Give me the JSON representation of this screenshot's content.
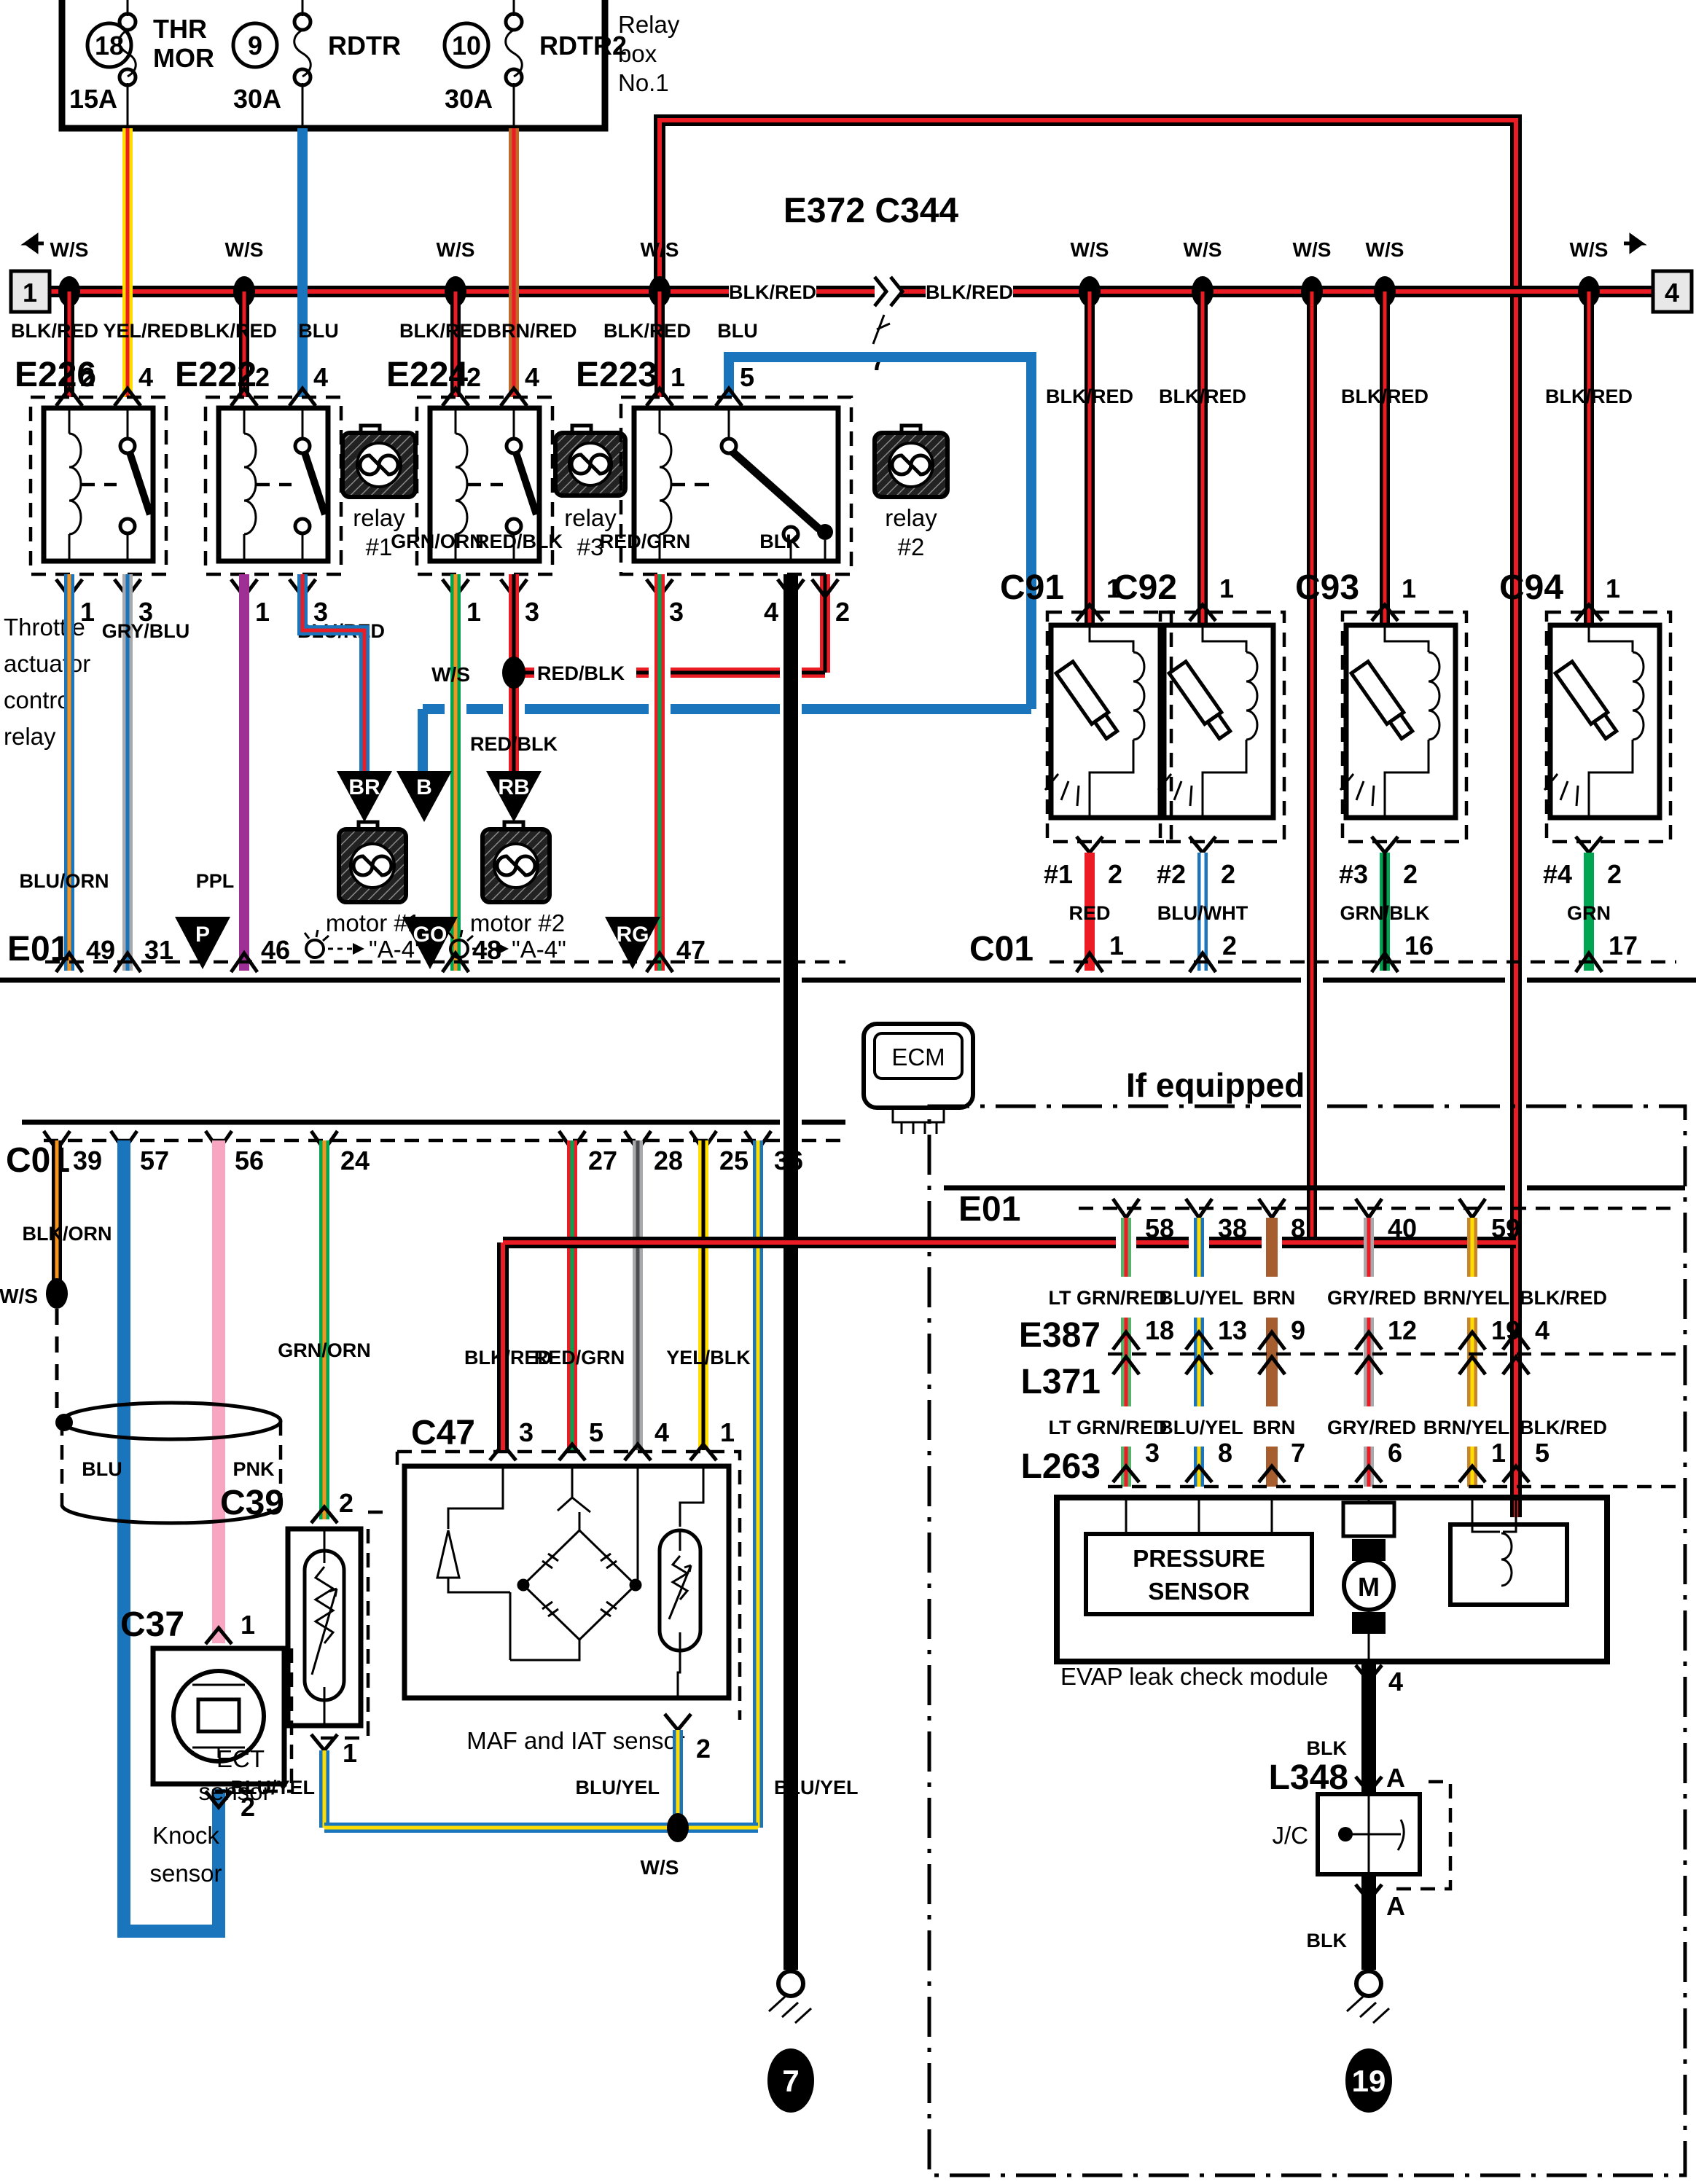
{
  "diagram": {
    "relay_box": {
      "title1": "Relay",
      "title2": "box",
      "title3": "No.1",
      "fuse1": {
        "num": "18",
        "amp": "15A",
        "name1": "THR",
        "name2": "MOR"
      },
      "fuse2": {
        "num": "9",
        "amp": "30A",
        "name": "RDTR"
      },
      "fuse3": {
        "num": "10",
        "amp": "30A",
        "name": "RDTR2"
      }
    },
    "terminal_left": "1",
    "terminal_right": "4",
    "ws": "W/S",
    "inline": {
      "id": "E372 C344",
      "pin": "7"
    },
    "wire": {
      "blkred": "BLK/RED",
      "yelred": "YEL/RED",
      "blu": "BLU",
      "brnred": "BRN/RED",
      "bluorn": "BLU/ORN",
      "gryblu": "GRY/BLU",
      "ppl": "PPL",
      "blured": "BLU/RED",
      "grnorn": "GRN/ORN",
      "redblk": "RED/BLK",
      "redgrn": "RED/GRN",
      "blk": "BLK",
      "red": "RED",
      "bluwht": "BLU/WHT",
      "grnblk": "GRN/BLK",
      "grn": "GRN",
      "blkorn": "BLK/ORN",
      "pnk": "PNK",
      "bluyel": "BLU/YEL",
      "ltgrnred": "LT GRN/RED",
      "brn": "BRN",
      "gryred": "GRY/RED",
      "brnyel": "BRN/YEL",
      "yelblk": "YEL/BLK"
    },
    "relays": {
      "e226": "E226",
      "e222": "E222",
      "e224": "E224",
      "e223": "E223",
      "throttle1": "Throttle",
      "throttle2": "actuator",
      "throttle3": "control",
      "throttle4": "relay",
      "fan_a": "relay",
      "fan1b": "#1",
      "fan3b": "#3",
      "fan2b": "#2"
    },
    "tri": {
      "br": "BR",
      "b": "B",
      "rb": "RB",
      "p": "P",
      "go": "GO",
      "rg": "RG"
    },
    "motor1": "motor #1",
    "motor2": "motor #2",
    "a4": "\"A-4\"",
    "e01": "E01",
    "c01": "C01",
    "inj": {
      "c91": "C91",
      "c92": "C92",
      "c93": "C93",
      "c94": "C94",
      "n1": "#1",
      "n2": "#2",
      "n3": "#3",
      "n4": "#4"
    },
    "ecm": "ECM",
    "sensors": {
      "c39": "C39",
      "c47": "C47",
      "c37": "C37",
      "ect1": "ECT",
      "ect2": "sensor",
      "maf": "MAF and IAT sensor",
      "knock1": "Knock",
      "knock2": "sensor"
    },
    "ifeq": "If equipped",
    "e387": "E387",
    "l371": "L371",
    "l263": "L263",
    "evap": {
      "label": "EVAP leak check module",
      "p1": "PRESSURE",
      "p2": "SENSOR",
      "m": "M"
    },
    "l348": {
      "id": "L348",
      "jc": "J/C",
      "a": "A"
    },
    "gnd": {
      "g7": "7",
      "g19": "19"
    },
    "num": {
      "1": "1",
      "2": "2",
      "3": "3",
      "4": "4",
      "5": "5",
      "6": "6",
      "7": "7",
      "8": "8",
      "9": "9",
      "12": "12",
      "13": "13",
      "16": "16",
      "17": "17",
      "18": "18",
      "19": "19",
      "24": "24",
      "25": "25",
      "27": "27",
      "28": "28",
      "31": "31",
      "36": "36",
      "38": "38",
      "39": "39",
      "40": "40",
      "46": "46",
      "47": "47",
      "48": "48",
      "49": "49",
      "56": "56",
      "57": "57",
      "58": "58",
      "59": "59"
    }
  }
}
